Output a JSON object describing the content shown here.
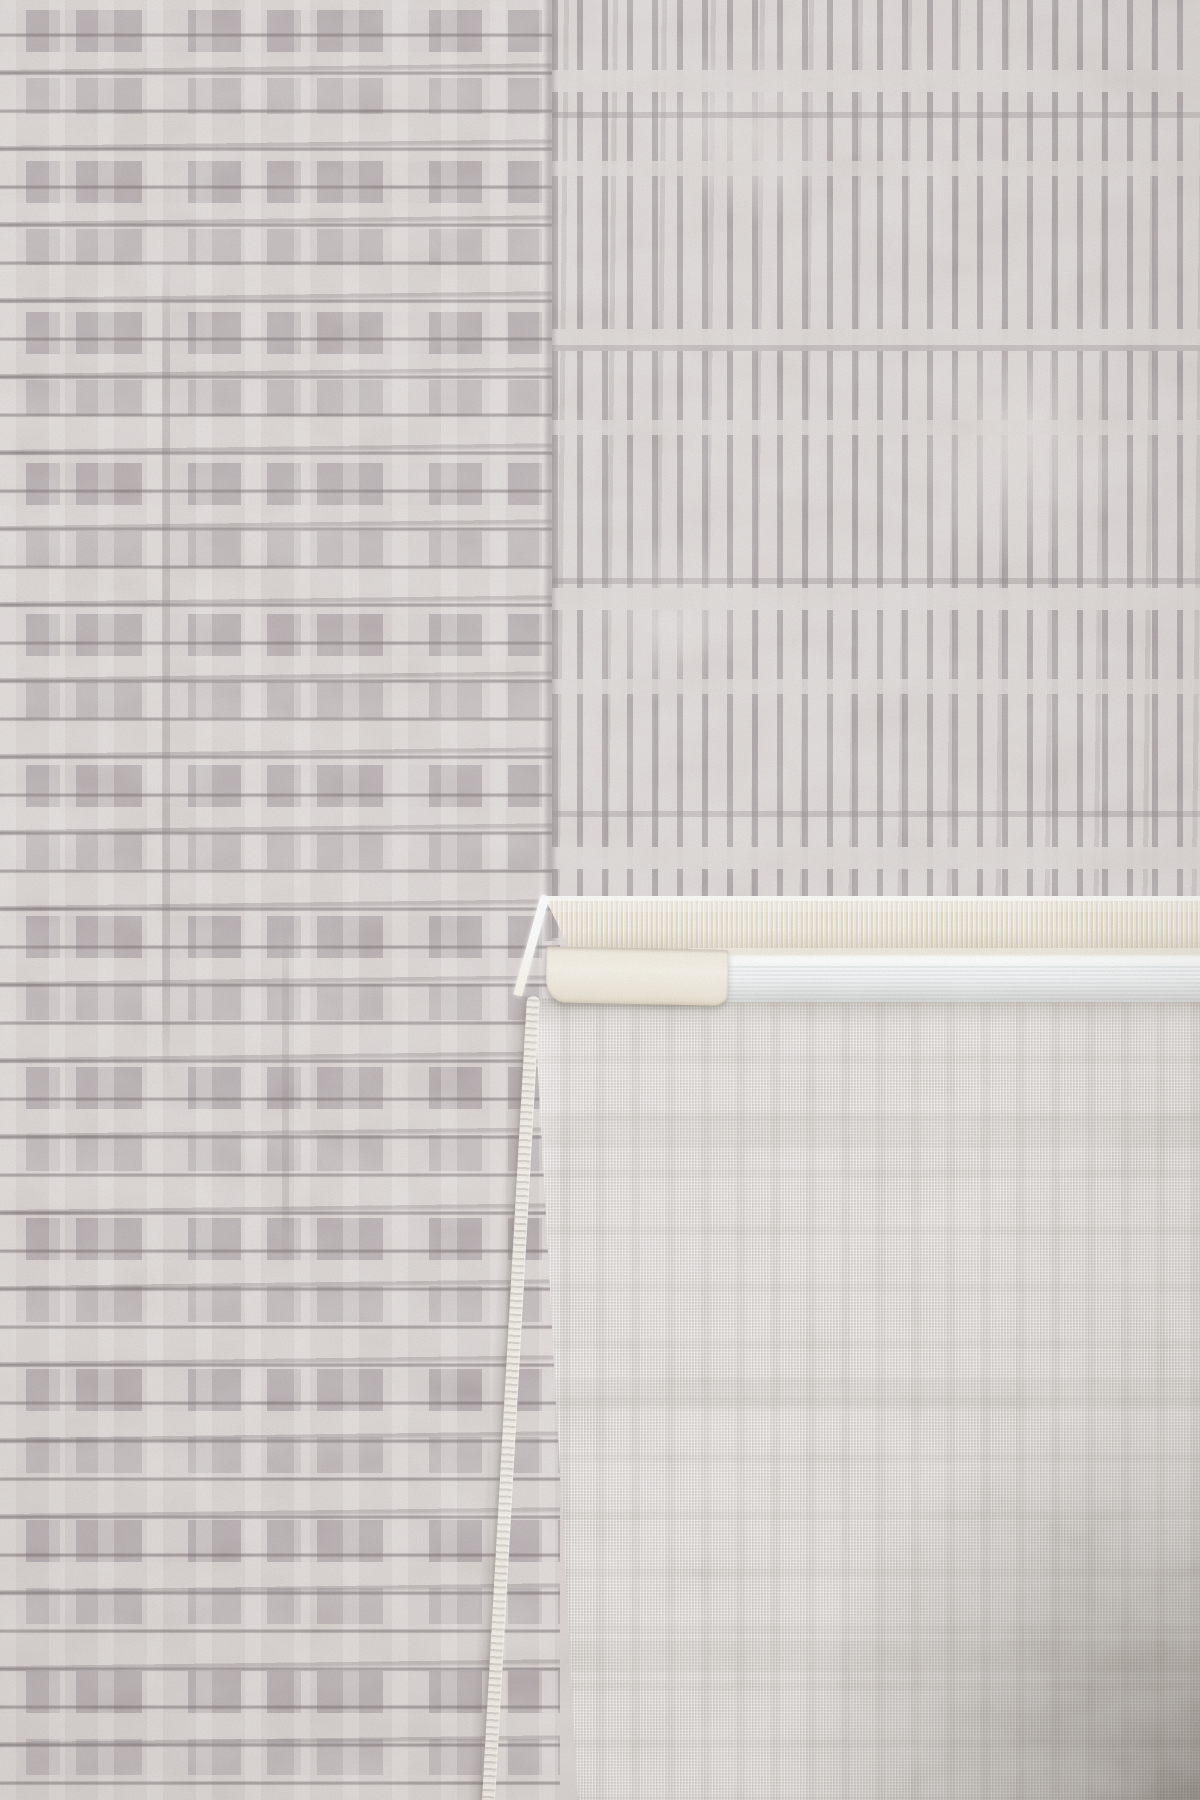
{
  "meta": {
    "title": "Close-up photo of a grey textured rug with its corner folded over",
    "subject": "rug-product-photo",
    "visible_text": ""
  },
  "palette": {
    "front_base_left": "#d6cfcc",
    "front_base_right": "#dad4d1",
    "patch_gray": "#a79da0",
    "stitch_dark": "#7e7476",
    "tuft_light": "#ece7e4",
    "fringe_cream": "#f4eee1",
    "tab_cream": "#f2ecdd",
    "binding_white": "#f0f3f4",
    "binding_highlight": "#fbfcfd",
    "backing_base": "#d9d4cf",
    "weave_dark": "#c3bdb6",
    "weave_light": "#efebe6",
    "edge_stitch_light": "#f3efe8",
    "edge_stitch_dark": "#cfc8bf",
    "corner_shadow": "#463d36"
  },
  "regions": {
    "front_left": {
      "label": "Rug front pile with horizontal broken stitch-row pattern in grey and cream"
    },
    "front_right": {
      "label": "Rug front pile with vertical maze-line pattern in grey and cream"
    },
    "seam": {
      "label": "Vertical seam between the two pattern fields"
    },
    "fold": {
      "label": "Bottom-right corner of the rug folded over to show the reverse side"
    },
    "backing": {
      "label": "Finely woven beige backing of the rug with faint ghost pattern and corner shadow"
    },
    "serged_edge": {
      "label": "Overlock-stitched side edge of the folded rug back"
    },
    "fringe": {
      "label": "Short cream fringe band along the folded rug edge"
    },
    "binding": {
      "label": "Smooth white binding tape sewn along the back edge"
    },
    "fold_tab": {
      "label": "Folded-over ribbed tab of the fringe band at the corner"
    },
    "edge_highlight": {
      "label": "Light catching the folded edge"
    }
  }
}
